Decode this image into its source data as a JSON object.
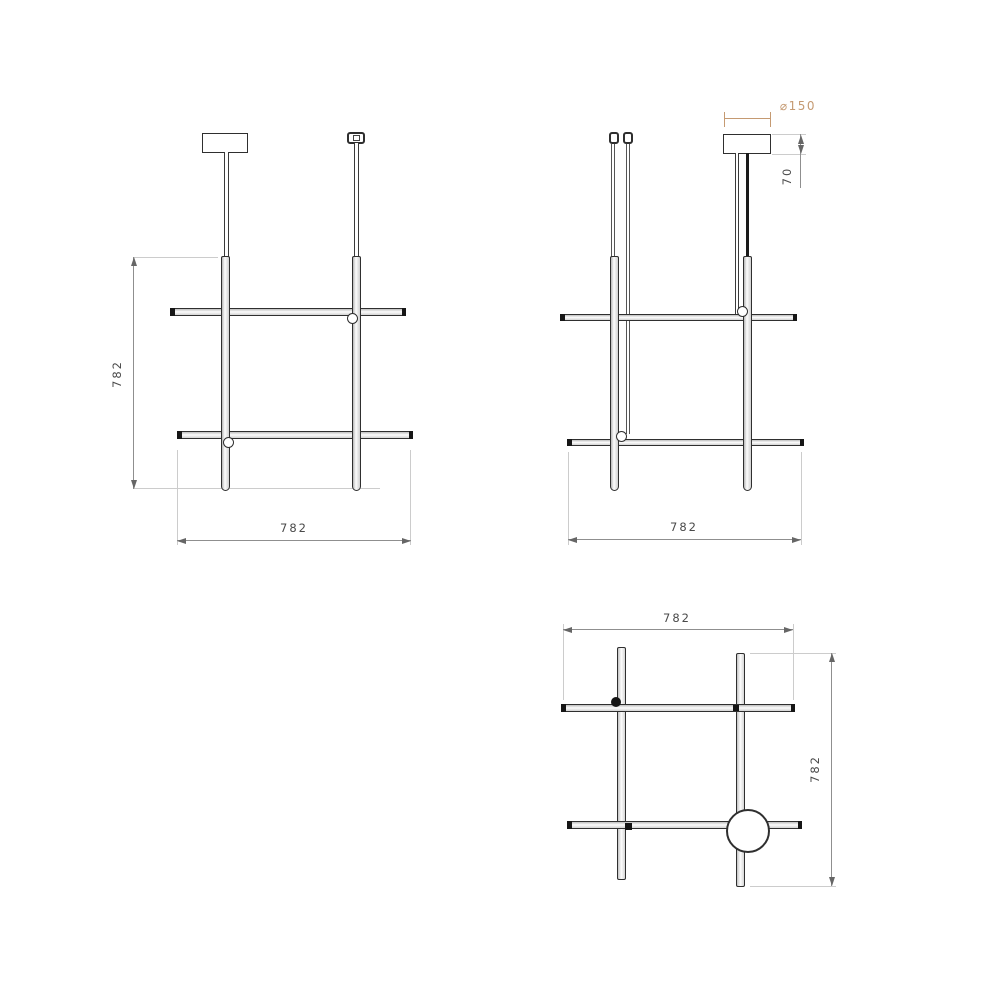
{
  "views": {
    "front": {
      "height_label": "782",
      "width_label": "782"
    },
    "side": {
      "width_label": "782",
      "canopy_diameter_label": "⌀150",
      "canopy_height_label": "70"
    },
    "plan": {
      "width_label": "782",
      "depth_label": "782"
    }
  },
  "colors": {
    "linework": "#2f2f2f",
    "dimension_line": "#8f8f8f",
    "extension_line": "#cccccc",
    "dimension_text": "#4a4a4a",
    "diameter_accent": "#c59a72",
    "background": "#ffffff"
  }
}
